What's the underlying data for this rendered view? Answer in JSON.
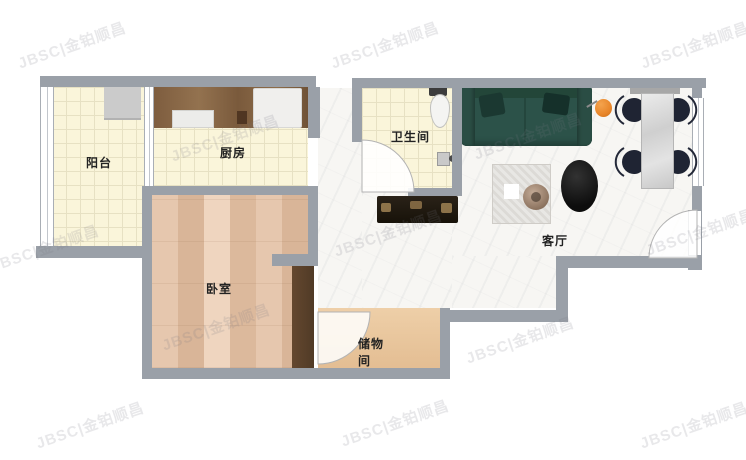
{
  "watermark": {
    "text": "JBSC|金铂顺昌"
  },
  "rooms": {
    "balcony": {
      "label": "阳台"
    },
    "kitchen": {
      "label": "厨房"
    },
    "bathroom": {
      "label": "卫生间"
    },
    "bedroom": {
      "label": "卧室"
    },
    "living_room": {
      "label": "客厅"
    },
    "storage": {
      "label": "储物间",
      "line1": "储物",
      "line2": "间"
    }
  },
  "colors": {
    "wall": "#9aa0a8",
    "tile_floor": "#faf5da",
    "wood_floor": "#e2c1a6",
    "storage_floor": "#eac79e",
    "marble_floor": "#f7f6f3",
    "kitchen_counter": "#81603f",
    "sofa_green": "#2c5249",
    "lamp_orange": "#e8862a",
    "chair_navy": "#1f2433",
    "coffee_table_black": "#111111",
    "door_leaf_brown": "#5a402c",
    "label_text": "#222222"
  },
  "furniture": [
    "washing-machine",
    "kitchen-counter",
    "stove",
    "fridge",
    "toilet",
    "shower-fixture",
    "sofa",
    "floor-lamp",
    "dining-table",
    "dining-chair",
    "coffee-table",
    "rug",
    "plant",
    "tv-console",
    "bedroom-door-leaf",
    "entry-door-leaf",
    "balcony-window",
    "side-window"
  ]
}
